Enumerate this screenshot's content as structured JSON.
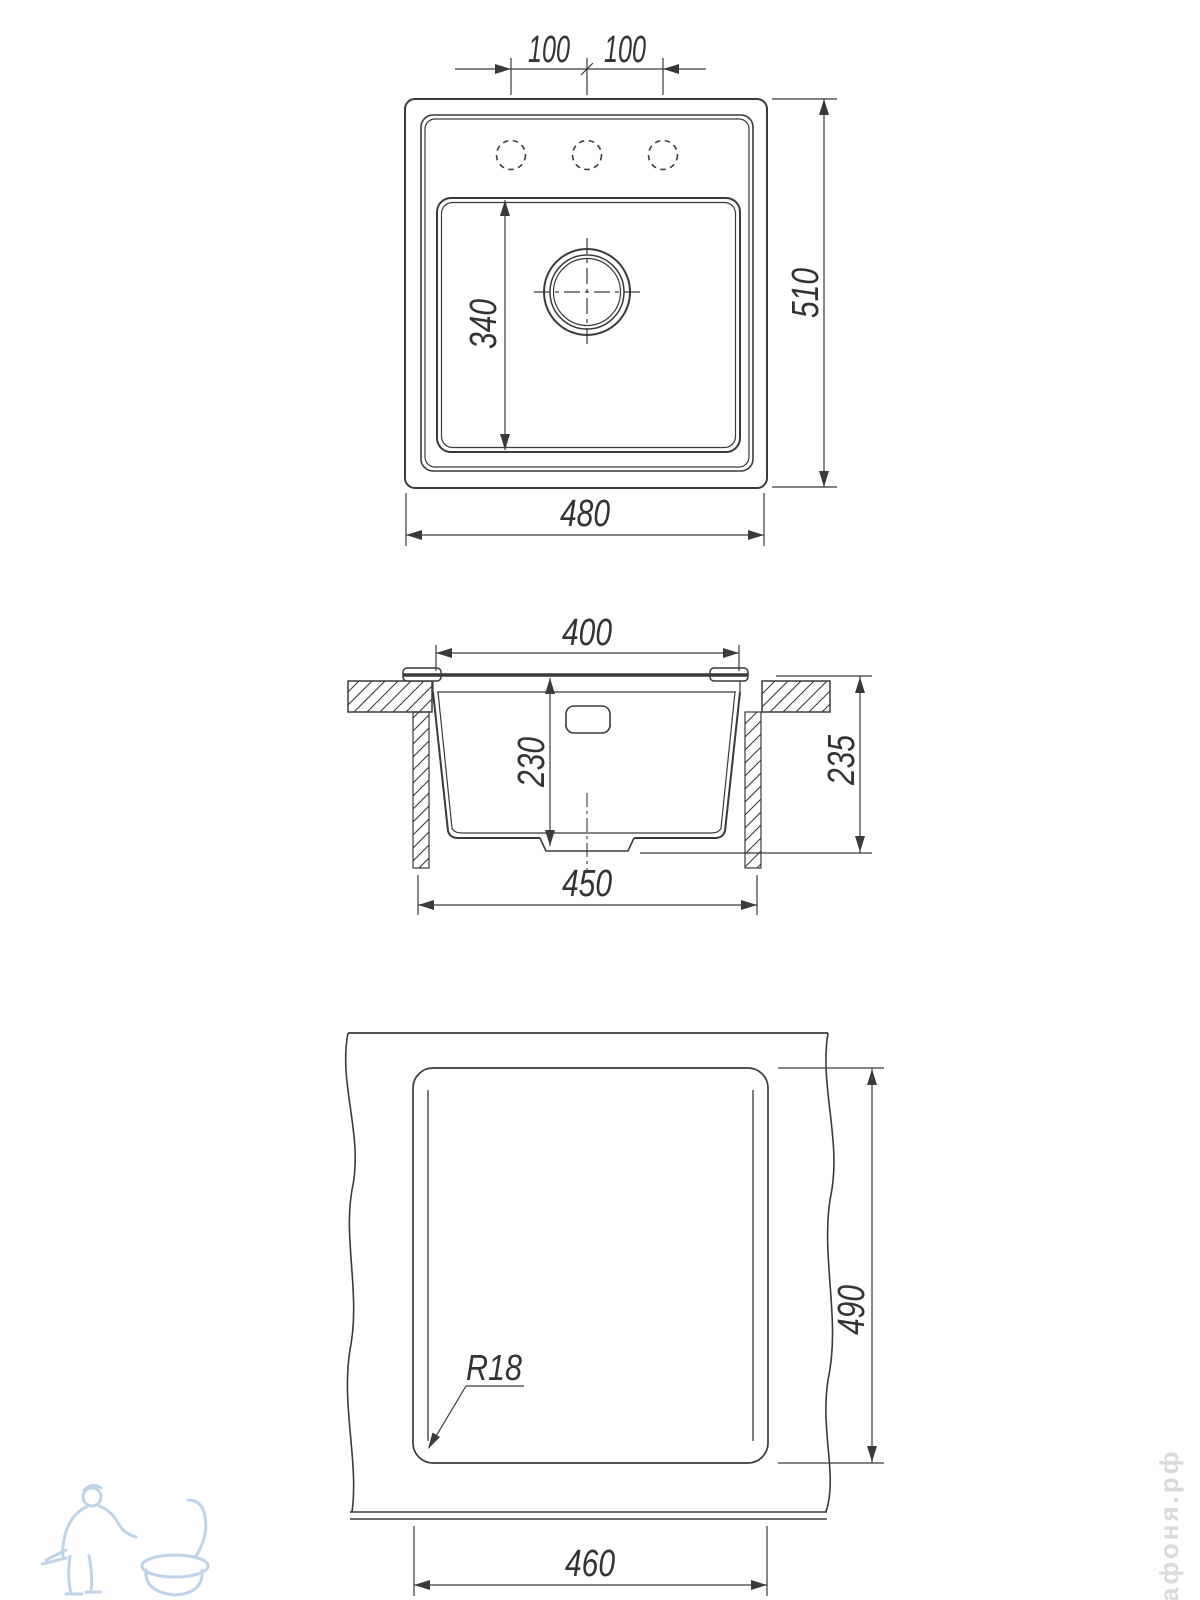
{
  "drawing": {
    "type": "technical-drawing",
    "subject": "kitchen sink dimensional drawing, three orthographic views",
    "line_color": "#3a3a3a",
    "views": {
      "top_view": {
        "label": "top view",
        "dim_hole_spacing_left": "100",
        "dim_hole_spacing_right": "100",
        "dim_bowl_length": "340",
        "dim_overall_length": "510",
        "dim_overall_width": "480"
      },
      "section_view": {
        "label": "cross-section view",
        "dim_bowl_top_width": "400",
        "dim_bowl_depth": "230",
        "dim_overall_height": "235",
        "dim_bottom_width": "450"
      },
      "cutout_view": {
        "label": "countertop cutout view",
        "dim_cutout_length": "490",
        "dim_corner_radius": "R18",
        "dim_cutout_width": "460"
      }
    },
    "watermarks": {
      "site_text": "афоня.рф",
      "logo_color": "#b9cfe6",
      "text_color": "#dadada"
    }
  }
}
